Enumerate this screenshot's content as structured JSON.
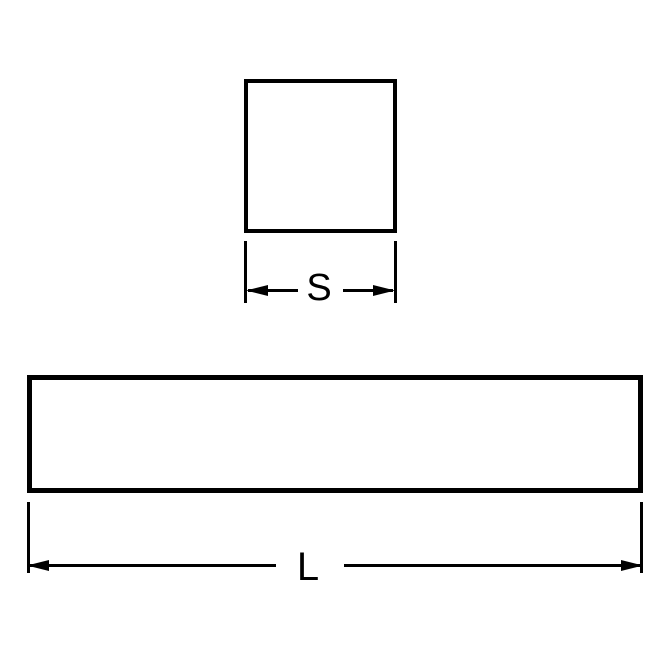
{
  "diagram": {
    "background_color": "#ffffff",
    "line_color": "#000000",
    "views": {
      "cross_section": {
        "shape": "square",
        "dimension_label": "S"
      },
      "length": {
        "shape": "rectangle",
        "dimension_label": "L"
      }
    }
  }
}
